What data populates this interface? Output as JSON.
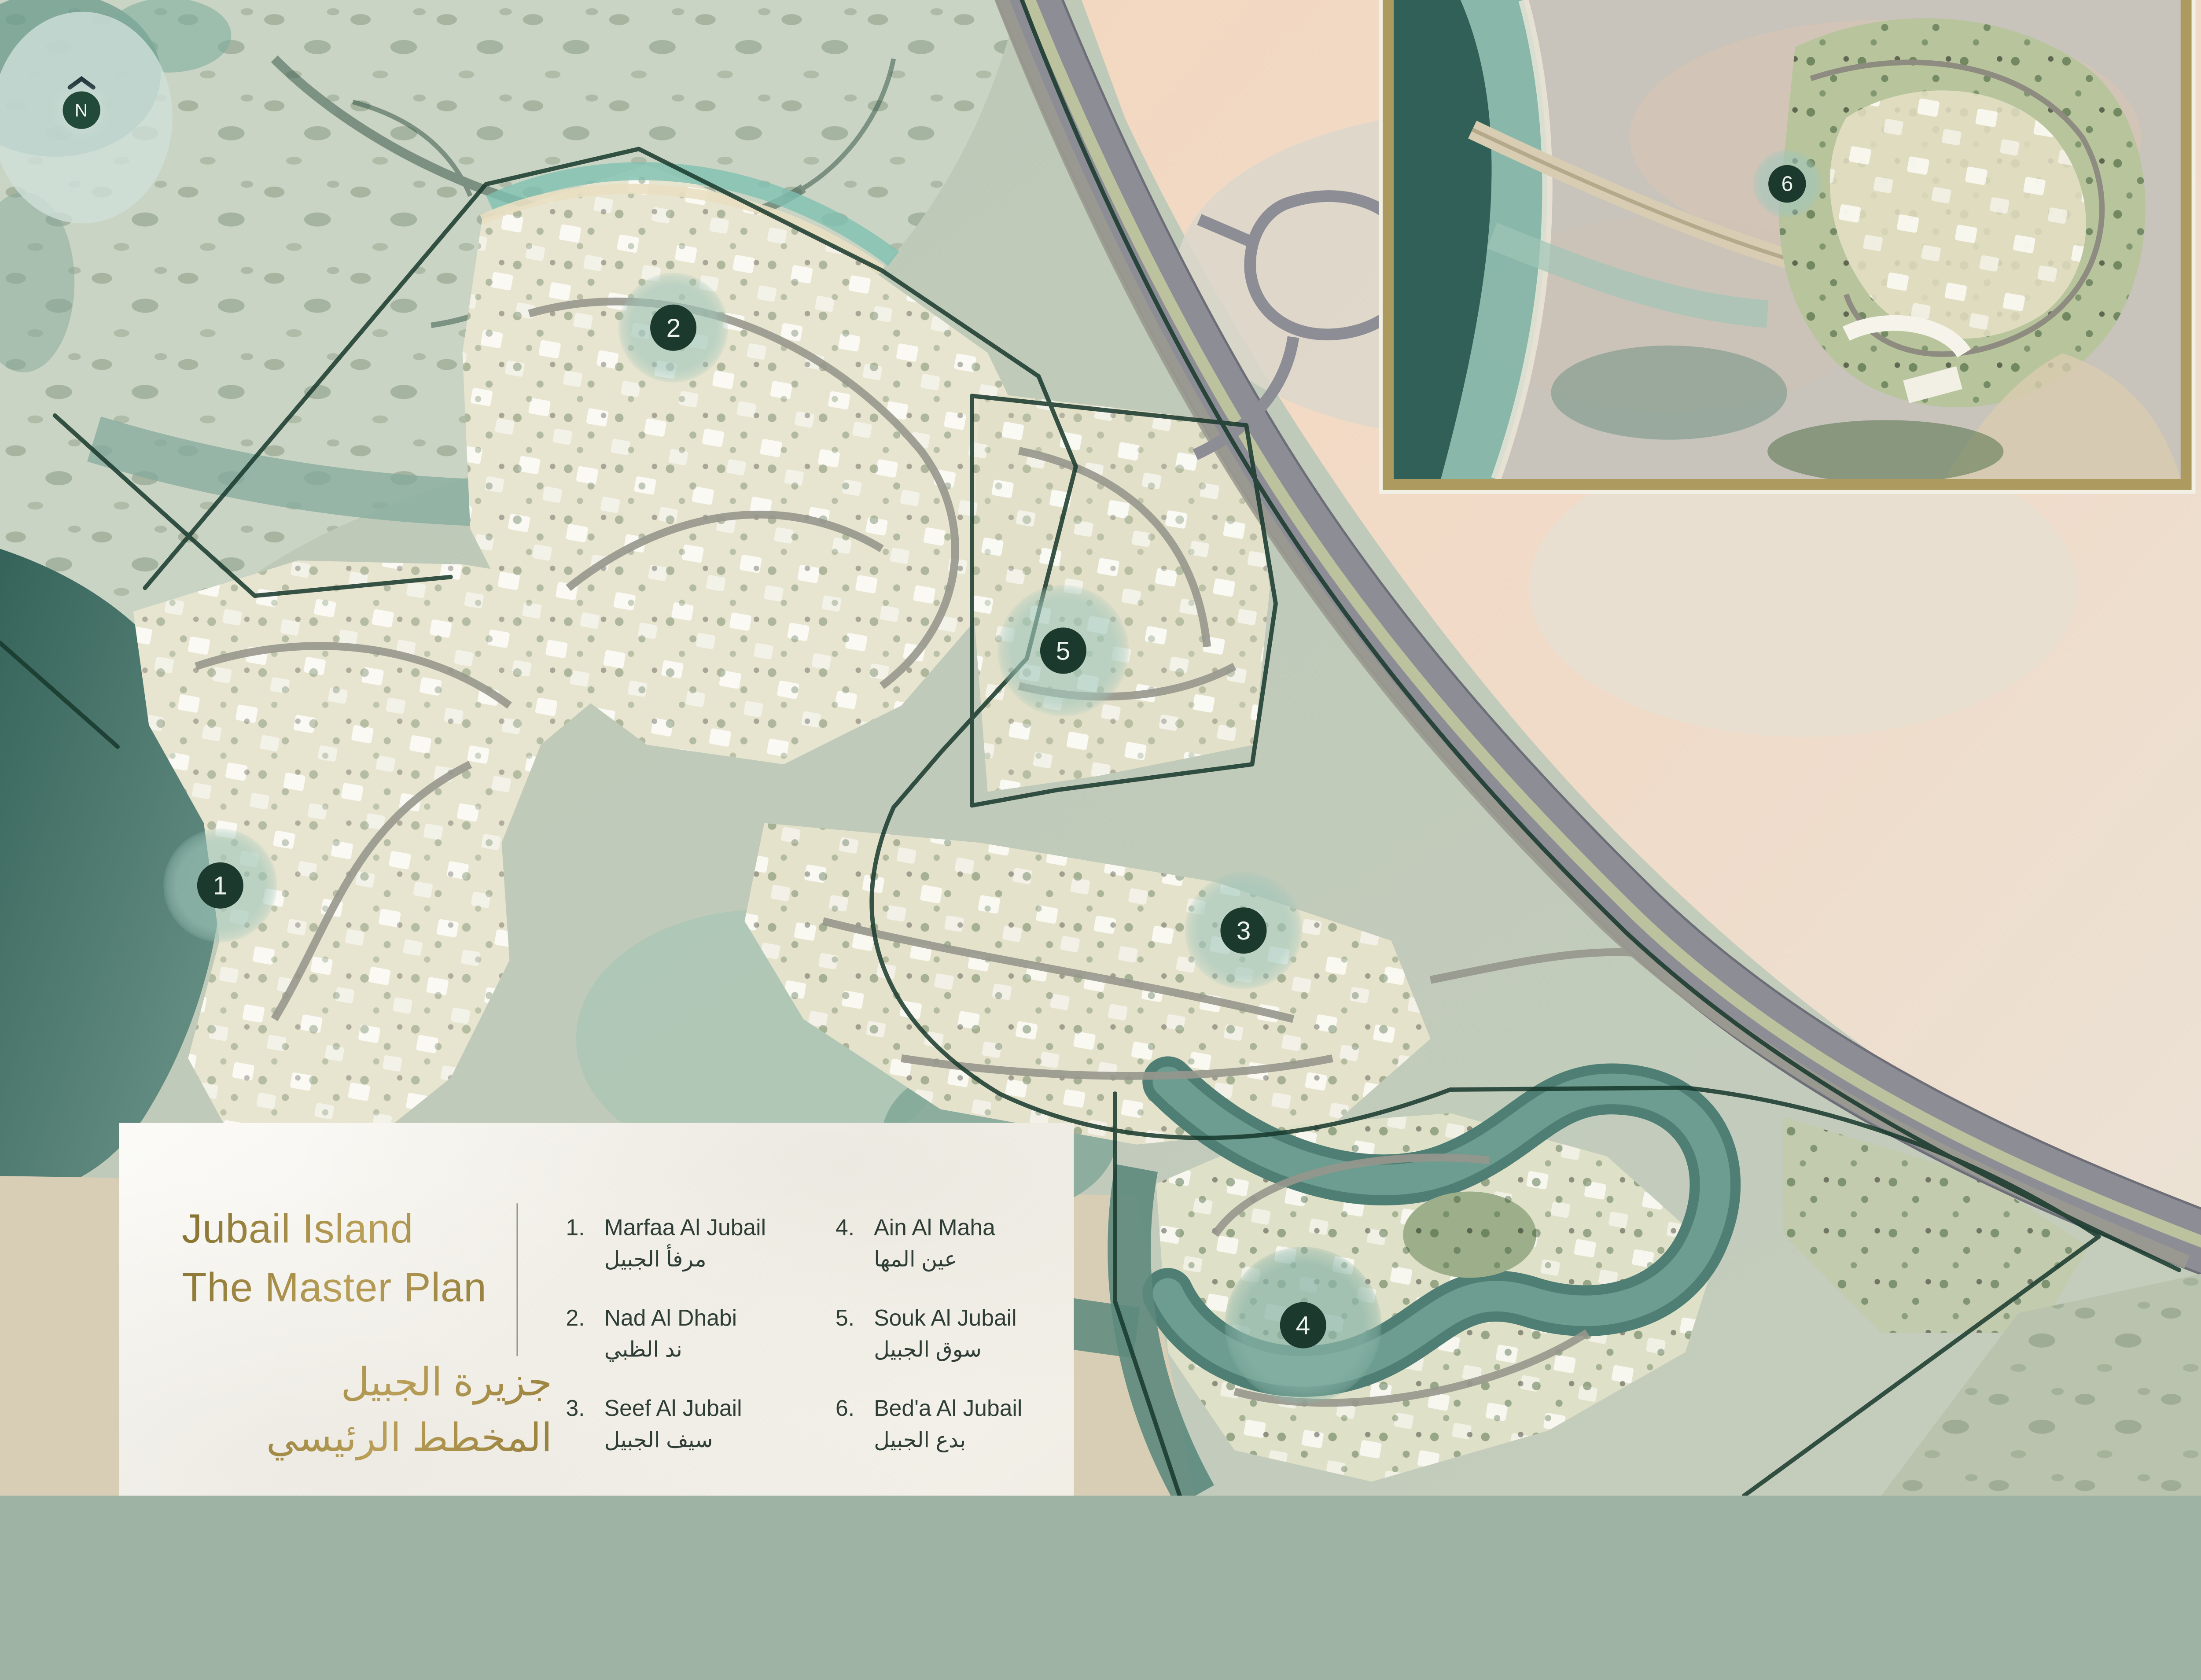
{
  "poster": {
    "type": "master-plan-satellite-map",
    "island": "Jubail Island"
  },
  "compass": {
    "label": "N"
  },
  "legend": {
    "title_en_line1": "Jubail Island",
    "title_en_line2": "The Master Plan",
    "title_ar_line1": "جزيرة الجبيل",
    "title_ar_line2": "المخطط الرئيسي",
    "items": [
      {
        "number": "1.",
        "name_en": "Marfaa Al Jubail",
        "name_ar": "مرفأ الجبيل"
      },
      {
        "number": "2.",
        "name_en": "Nad Al Dhabi",
        "name_ar": "ند الظبي"
      },
      {
        "number": "3.",
        "name_en": "Seef Al Jubail",
        "name_ar": "سيف الجبيل"
      },
      {
        "number": "4.",
        "name_en": "Ain Al Maha",
        "name_ar": "عين المها"
      },
      {
        "number": "5.",
        "name_en": "Souk Al Jubail",
        "name_ar": "سوق الجبيل"
      },
      {
        "number": "6.",
        "name_en": "Bed'a Al Jubail",
        "name_ar": "بدع الجبيل"
      }
    ]
  },
  "markers": [
    {
      "label": "1",
      "x_pct": 10.0,
      "y_pct": 59.2
    },
    {
      "label": "2",
      "x_pct": 30.6,
      "y_pct": 21.9
    },
    {
      "label": "3",
      "x_pct": 56.5,
      "y_pct": 62.2
    },
    {
      "label": "4",
      "x_pct": 59.2,
      "y_pct": 88.6
    },
    {
      "label": "5",
      "x_pct": 48.3,
      "y_pct": 43.5
    },
    {
      "label": "6",
      "x_pct": 81.2,
      "y_pct": 12.3
    }
  ],
  "colors": {
    "marker_badge": "#1b3a2d",
    "marker_halo": "#9dc3b7",
    "accent_gold": "#a8904d",
    "boundary_line": "#17382c",
    "inset_border": "#ac9a5e",
    "legend_text": "#2e3e37"
  }
}
